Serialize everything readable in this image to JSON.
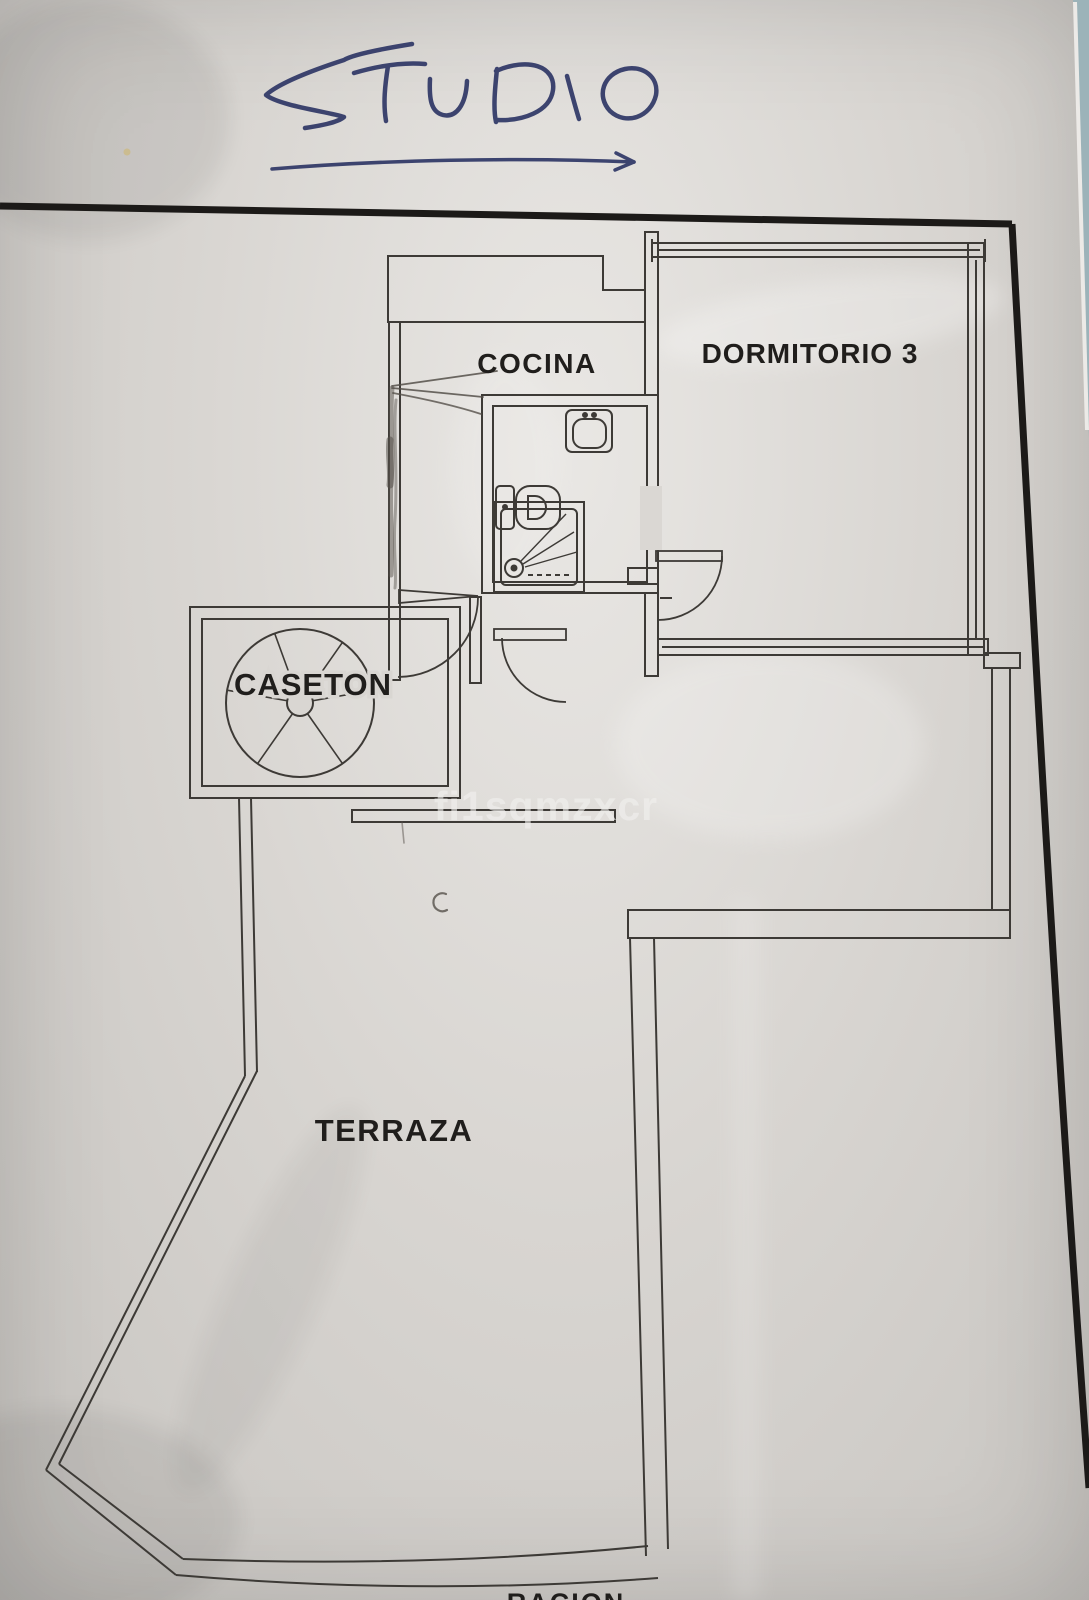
{
  "title_handwritten": "STUDIO",
  "watermark": "fi1sqmzxcr",
  "rooms": {
    "cocina": "COCINA",
    "dormitorio": "DORMITORIO 3",
    "caseton": "CASETON",
    "terraza": "TERRAZA"
  },
  "bottom_partial_label": "RACION",
  "fixtures": [
    "spiral-staircase",
    "toilet",
    "sink",
    "shower",
    "door-swing-arc"
  ],
  "colors": {
    "paper": "#d8d5d1",
    "plan_line": "#3d3a36",
    "page_border": "#1c1a18",
    "label_text": "#201e1c",
    "ink_blue": "#2f3766",
    "watermark": "#f2f1ef",
    "desk_teal": "#9cb3b9",
    "pencil": "#55504a"
  }
}
